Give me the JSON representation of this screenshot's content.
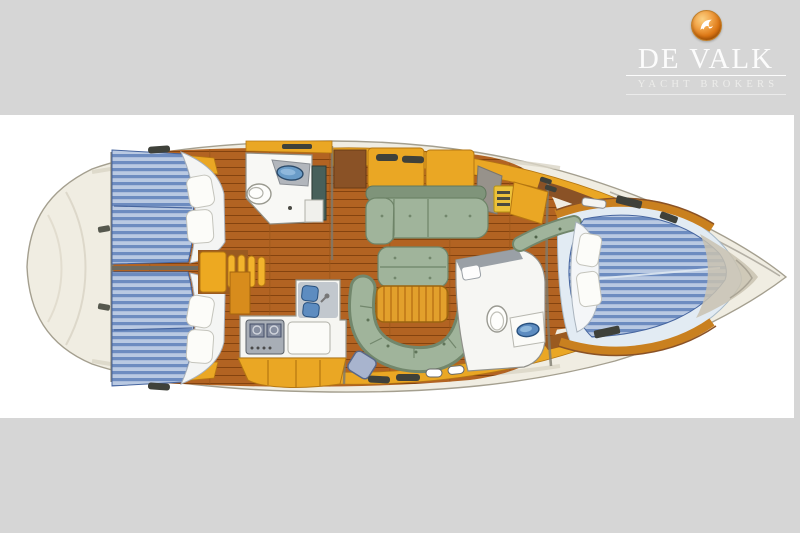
{
  "page": {
    "background_color": "#d6d6d6",
    "canvas_color": "#ffffff"
  },
  "logo": {
    "brand": "DE VALK",
    "tagline": "YACHT BROKERS",
    "emblem": "falcon-orb-icon",
    "emblem_orange": "#dd7714",
    "text_color": "#fcfcfc"
  },
  "diagram": {
    "kind": "sailing-yacht-interior-floor-plan",
    "view": "top-down",
    "orientation": "stern-left-bow-right",
    "features": [
      {
        "name": "hull",
        "color": "#f0ede2"
      },
      {
        "name": "aft-deck",
        "color": "#f0ede2"
      },
      {
        "name": "port-aft-cabin-berth",
        "color": "#6d8cc0",
        "pillows": 2
      },
      {
        "name": "starboard-aft-cabin-berth",
        "color": "#6d8cc0",
        "pillows": 2
      },
      {
        "name": "companionway-steps",
        "color": "#eda921"
      },
      {
        "name": "aft-heads",
        "fixtures": [
          "toilet",
          "washbasin",
          "shower"
        ]
      },
      {
        "name": "galley",
        "fixtures": [
          "stove",
          "double-sink",
          "worktop",
          "cabinets"
        ]
      },
      {
        "name": "salon-port-settee",
        "color": "#a0b49b"
      },
      {
        "name": "salon-island-seat",
        "color": "#a0b49b"
      },
      {
        "name": "salon-table",
        "color": "#e2a02c"
      },
      {
        "name": "salon-u-settee",
        "color": "#a0b49b"
      },
      {
        "name": "nav-stool",
        "color": "#a8b4ce"
      },
      {
        "name": "forward-heads",
        "fixtures": [
          "toilet",
          "washbasin"
        ]
      },
      {
        "name": "forward-cabin-v-berth",
        "color": "#6d8cc0",
        "pillows": 2
      },
      {
        "name": "bow-anchor-locker",
        "color": "#c9c2b0"
      },
      {
        "name": "hull-windows",
        "color": "#3f413a"
      }
    ],
    "palette": {
      "hull_cream": "#f0ede2",
      "hull_stroke": "#a49f8f",
      "wood_floor": "#b26322",
      "wood_dark": "#8a5226",
      "cabinet_orange": "#eaa724",
      "berth_stripe_light": "#b9c9e2",
      "berth_stripe_dark": "#6d8cc0",
      "upholstery_green": "#a0b49b",
      "upholstery_green_dark": "#72876c",
      "fixture_white": "#f8f8f5",
      "sink_blue": "#5d8cc0",
      "window_dark": "#3f413a",
      "platform_light_blue": "#e2ebf3"
    }
  }
}
